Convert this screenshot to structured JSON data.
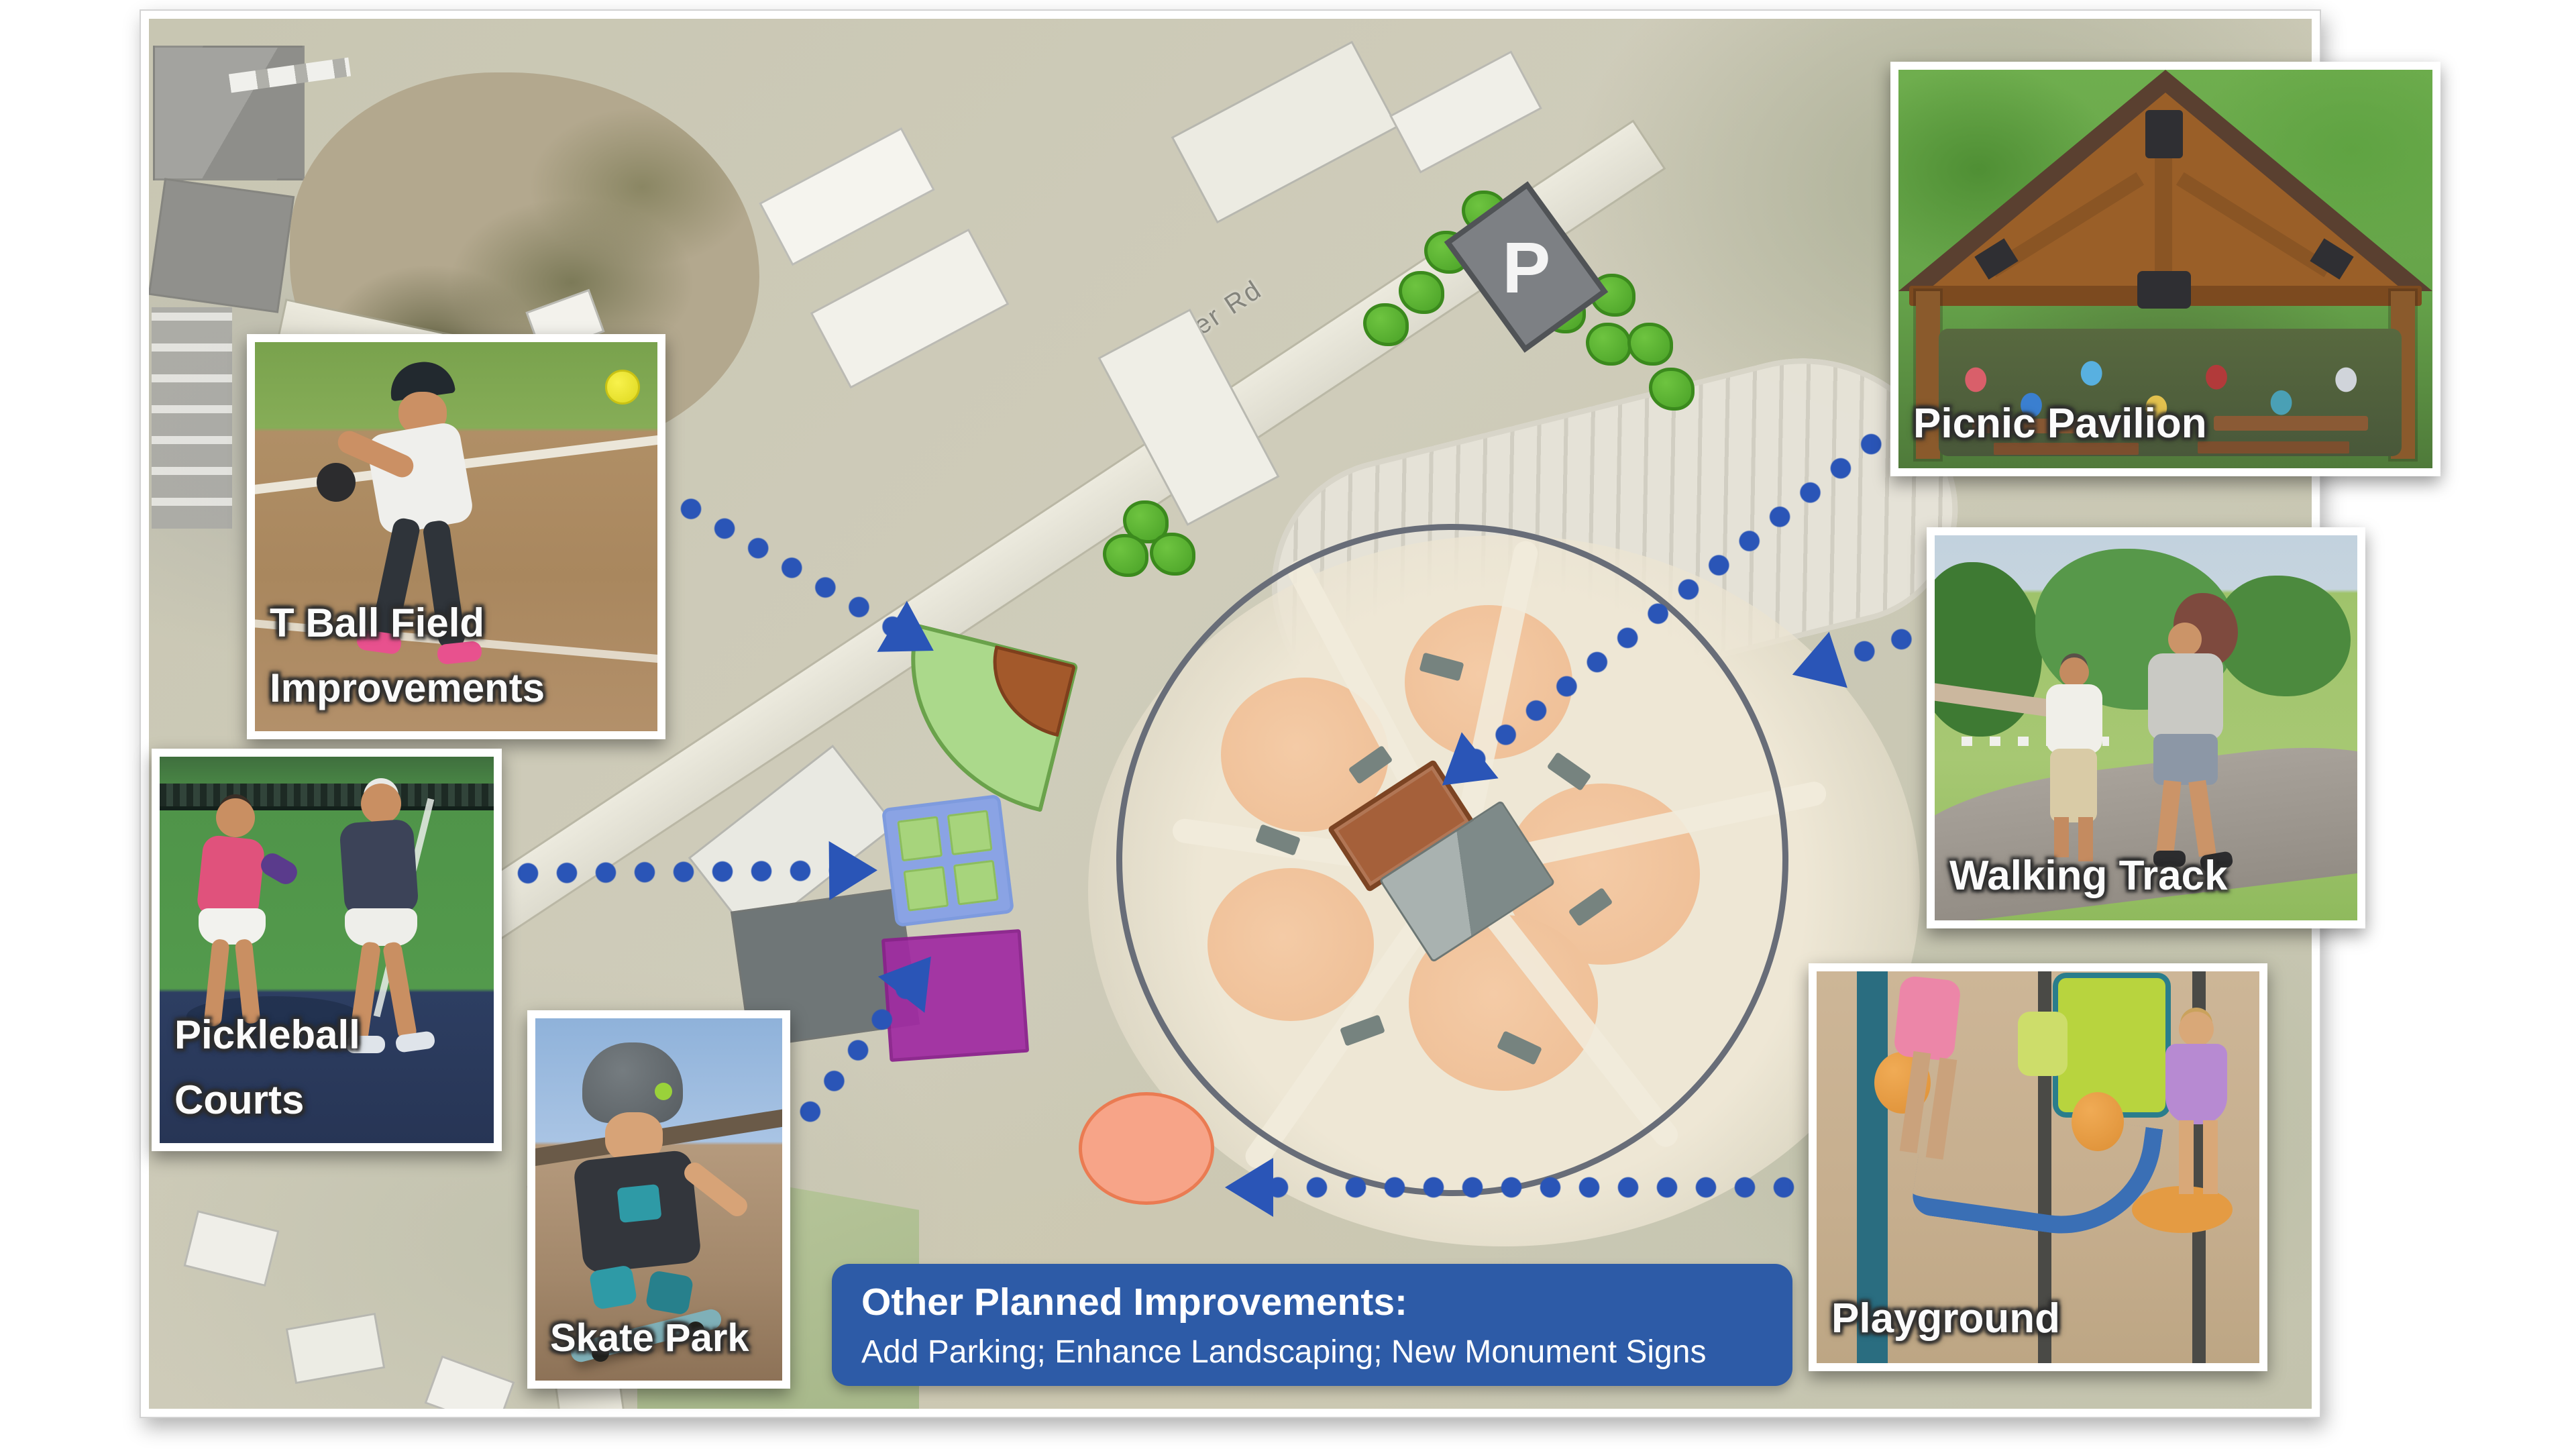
{
  "map": {
    "road_label": "Univeter Rd",
    "parking_marker": "P",
    "colors": {
      "arrow_blue": "#2a55b7",
      "banner_blue": "#2d5ba7",
      "tree_green": "#4aa227",
      "walking_track_ring": "#686d78",
      "tball_fan": "#abd98b",
      "tball_infield": "#a3592b",
      "pickleball_frame": "#8aa3e4",
      "pickleball_court": "#a7d47c",
      "skate_park": "#a02ba2",
      "playground": "#f7a488",
      "picnic_pavilion_marker": "#a5603a",
      "parking_sign_gray": "#7d8084",
      "ballfield_infield": "#f0c4a0"
    }
  },
  "callouts": [
    {
      "id": "tball",
      "label": "T Ball Field Improvements",
      "line1": "T Ball Field",
      "line2": "Improvements"
    },
    {
      "id": "pickleball",
      "label": "Pickleball Courts",
      "line1": "Pickleball",
      "line2": "Courts"
    },
    {
      "id": "skate",
      "label": "Skate Park"
    },
    {
      "id": "pavilion",
      "label": "Picnic Pavilion"
    },
    {
      "id": "walking",
      "label": "Walking Track"
    },
    {
      "id": "playground",
      "label": "Playground"
    }
  ],
  "banner": {
    "title": "Other Planned Improvements:",
    "details": "Add Parking; Enhance Landscaping; New Monument Signs"
  }
}
